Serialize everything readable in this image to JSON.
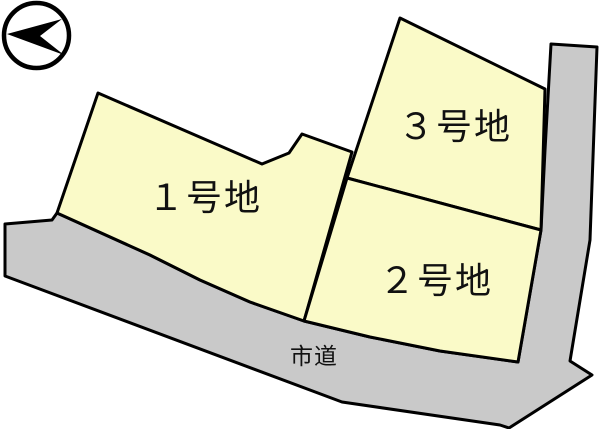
{
  "diagram": {
    "type": "land-lot-layout",
    "plots": [
      {
        "label": "１号地"
      },
      {
        "label": "２号地"
      },
      {
        "label": "３号地"
      }
    ],
    "road": {
      "label": "市道"
    },
    "icons": {
      "compass": "north-arrow-icon"
    },
    "colors": {
      "plot_fill": "#FAFAC8",
      "road_fill": "#C9C9C9",
      "outline": "#000000",
      "text": "#111111",
      "background": "#FFFFFF"
    }
  }
}
